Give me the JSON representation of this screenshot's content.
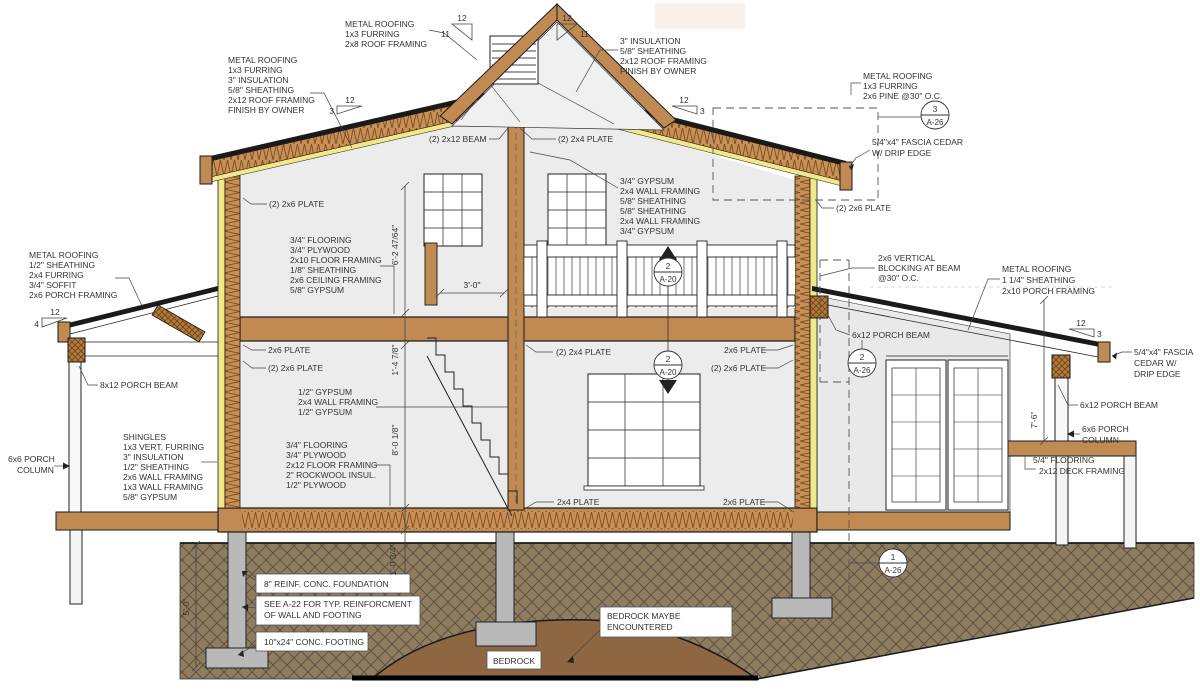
{
  "drawing": {
    "type": "architectural-section",
    "colors": {
      "wood": "#c08a52",
      "insulation_yellow": "#f1e88a",
      "insulation_hatch": "#c89058",
      "room_gray": "#ececec",
      "ground": "#8f7d60",
      "bedrock": "#8c6742",
      "concrete": "#b9b9b9",
      "line": "#1a1a1a"
    },
    "labels": {
      "gable_roof": [
        "METAL ROOFING",
        "1x3 FURRING",
        "2x8 ROOF FRAMING"
      ],
      "left_roof": [
        "METAL ROOFING",
        "1x3 FURRING",
        "3\" INSULATION",
        "5/8\" SHEATHING",
        "2x12 ROOF FRAMING",
        "FINISH BY OWNER"
      ],
      "right_roof": [
        "3\" INSULATION",
        "5/8\" SHEATHING",
        "2x12 ROOF FRAMING",
        "FINISH BY OWNER"
      ],
      "far_right_roof": [
        "METAL ROOFING",
        "1x3 FURRING",
        "2x6 PINE @30\" O.C."
      ],
      "fascia_top": [
        "5/4\"x4\" FASCIA CEDAR",
        "W/ DRIP EDGE"
      ],
      "plate_far_right": "(2) 2x6 PLATE",
      "beam_2x12": "(2) 2x12 BEAM",
      "plate_2x4_top": "(2) 2x4 PLATE",
      "floor2_assembly": [
        "3/4\" FLOORING",
        "3/4\" PLYWOOD",
        "2x10 FLOOR FRAMING",
        "1/8\" SHEATHING",
        "2x6 CEILING FRAMING",
        "5/8\" GYPSUM"
      ],
      "center_wall": [
        "3/4\" GYPSUM",
        "2x4 WALL FRAMING",
        "5/8\" SHEATHING",
        "5/8\" SHEATHING",
        "2x4 WALL FRAMING",
        "3/4\" GYPSUM"
      ],
      "plate_upper_left": "(2) 2x6 PLATE",
      "left_porch_roof": [
        "METAL ROOFING",
        "1/2\" SHEATHING",
        "2x4 FURRING",
        "3/4\" SOFFIT",
        "2x6 PORCH FRAMING"
      ],
      "porch_beam_left": "8x12 PORCH BEAM",
      "porch_col_left": [
        "6x6 PORCH",
        "COLUMN"
      ],
      "ext_wall": [
        "SHINGLES",
        "1x3 VERT. FURRING",
        "3\" INSULATION",
        "1/2\" SHEATHING",
        "2x6 WALL FRAMING",
        "1x3 WALL FRAMING",
        "5/8\" GYPSUM"
      ],
      "plate_mid_left_a": "2x6 PLATE",
      "plate_mid_left_b": "(2) 2x6 PLATE",
      "int_wall": [
        "1/2\" GYPSUM",
        "2x4 WALL FRAMING",
        "1/2\" GYPSUM"
      ],
      "floor1_assembly": [
        "3/4\" FLOORING",
        "3/4\" PLYWOOD",
        "2x12 FLOOR FRAMING",
        "2\" ROCKWOOL INSUL.",
        "1/2\" PLYWOOD"
      ],
      "plate_mid_center": "(2) 2x4 PLATE",
      "plate_mid_right_a": "2x6 PLATE",
      "plate_mid_right_b": "(2) 2x6 PLATE",
      "blocking": [
        "2x6 VERTICAL",
        "BLOCKING AT BEAM",
        "@30\" O.C."
      ],
      "right_porch_roof": [
        "METAL ROOFING",
        "1 1/4\" SHEATHING",
        "2x10 PORCH FRAMING"
      ],
      "porch_beam_right_a": "6x12 PORCH BEAM",
      "fascia_low": [
        "5/4\"x4\" FASCIA",
        "CEDAR W/",
        "DRIP EDGE"
      ],
      "porch_beam_right_b": "6x12 PORCH BEAM",
      "porch_col_right": [
        "6x6 PORCH",
        "COLUMN"
      ],
      "deck": [
        "5/4\" FLOORING",
        "2x12 DECK FRAMING"
      ],
      "plate_bottom_center": "2x4 PLATE",
      "plate_bottom_right": "2x6 PLATE",
      "foundation_wall": "8\" REINF. CONC. FOUNDATION",
      "see_note": [
        "SEE A-22 FOR TYP. REINFORCMENT",
        "OF WALL AND FOOTING"
      ],
      "footing": "10\"x24\" CONC. FOOTING",
      "bedrock_note": [
        "BEDROCK MAYBE",
        "ENCOUNTERED"
      ],
      "bedrock": "BEDROCK"
    },
    "dimensions": {
      "floor2_height": "6'-2 47/64\"",
      "floor_depth": "1'-4 7/8\"",
      "floor1_height": "8'-0 1/8\"",
      "slab_depth": "1'-0 3/4\"",
      "foundation_depth": "5'-0\"",
      "porch_height": "7'-6\"",
      "stair_width": "3'-0\""
    },
    "slopes": {
      "gable_left": {
        "run": "12",
        "rise": "11"
      },
      "gable_right": {
        "run": "12",
        "rise": "11"
      },
      "main_left": {
        "run": "12",
        "rise": "3"
      },
      "main_right": {
        "run": "12",
        "rise": "3"
      },
      "porch_left": {
        "run": "12",
        "rise": "4"
      },
      "porch_right": {
        "run": "12",
        "rise": "3"
      }
    },
    "callouts": {
      "c_top_right": {
        "num": "3",
        "sheet": "A-26"
      },
      "c_balcony": {
        "num": "2",
        "sheet": "A-20"
      },
      "c_stair": {
        "num": "2",
        "sheet": "A-20"
      },
      "c_porch_beam": {
        "num": "2",
        "sheet": "A-26"
      },
      "c_foundation": {
        "num": "1",
        "sheet": "A-26"
      }
    }
  }
}
